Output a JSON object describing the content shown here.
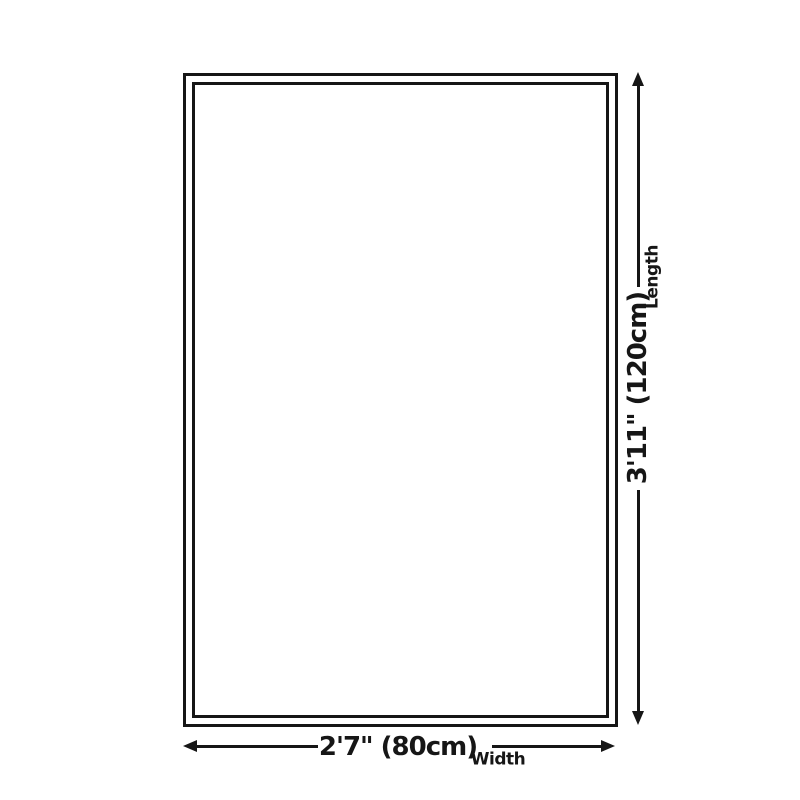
{
  "diagram": {
    "type": "rug-size-diagram",
    "background_color": "#ffffff",
    "line_color": "#161616",
    "rug": {
      "shape": "rectangle",
      "border_style": "double-outline"
    },
    "length_dimension": {
      "value": "3'11\" (120cm)",
      "label": "Length",
      "orientation": "vertical",
      "arrows": [
        "up-arrow-icon",
        "down-arrow-icon"
      ]
    },
    "width_dimension": {
      "value": "2'7\" (80cm)",
      "label": "Width",
      "orientation": "horizontal",
      "arrows": [
        "left-arrow-icon",
        "right-arrow-icon"
      ]
    }
  }
}
